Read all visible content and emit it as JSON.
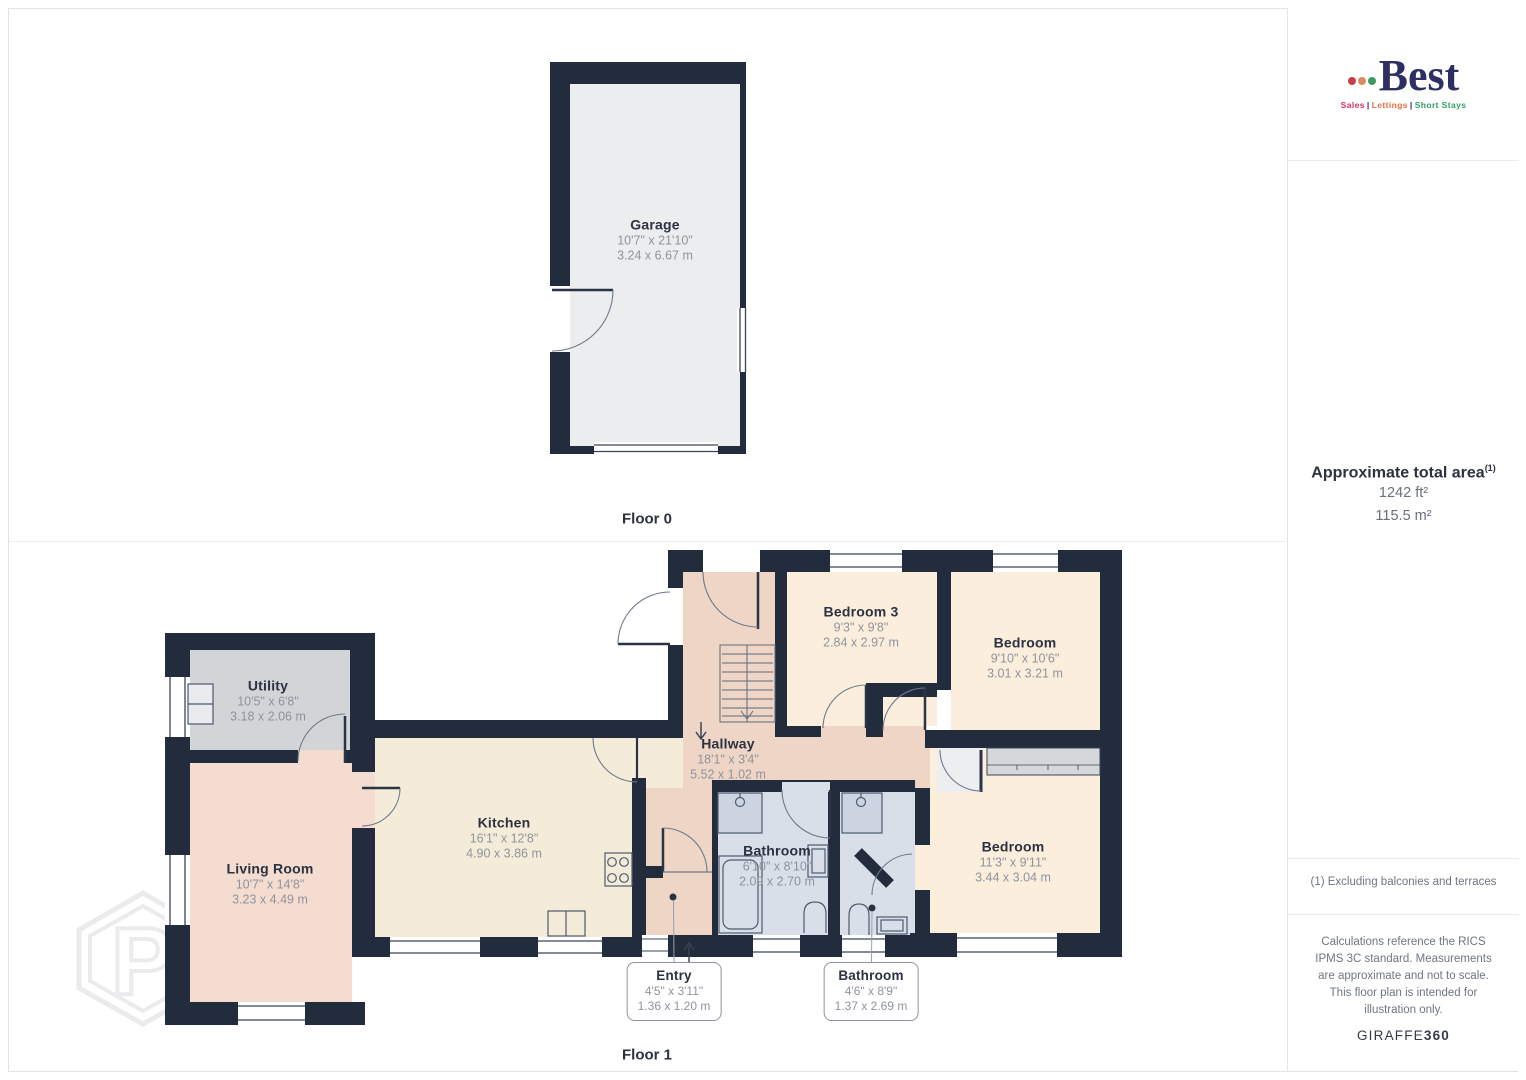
{
  "page": {
    "floor0_label": "Floor 0",
    "floor1_label": "Floor 1"
  },
  "branding": {
    "name": "Best",
    "separator": "|",
    "tagline": [
      "Sales",
      "Lettings",
      "Short Stays"
    ]
  },
  "sidebar": {
    "area_title": "Approximate total area",
    "area_sup": "(1)",
    "area_ft": "1242 ft²",
    "area_m": "115.5 m²",
    "footnote": "(1) Excluding balconies and terraces",
    "disclaimer": "Calculations reference the RICS IPMS 3C standard. Measurements are approximate and not to scale. This floor plan is intended for illustration only.",
    "brand_regular": "GIRAFFE",
    "brand_bold": "360"
  },
  "watermark": {
    "letter": "P"
  },
  "rooms": {
    "garage": {
      "name": "Garage",
      "imperial": "10'7\" x 21'10\"",
      "metric": "3.24 x 6.67 m"
    },
    "utility": {
      "name": "Utility",
      "imperial": "10'5\" x 6'8\"",
      "metric": "3.18 x 2.06 m"
    },
    "living": {
      "name": "Living Room",
      "imperial": "10'7\" x 14'8\"",
      "metric": "3.23 x 4.49 m"
    },
    "kitchen": {
      "name": "Kitchen",
      "imperial": "16'1\" x 12'8\"",
      "metric": "4.90 x 3.86 m"
    },
    "hallway": {
      "name": "Hallway",
      "imperial": "18'1\" x 3'4\"",
      "metric": "5.52 x 1.02 m"
    },
    "bedroom3": {
      "name": "Bedroom 3",
      "imperial": "9'3\" x 9'8\"",
      "metric": "2.84 x 2.97 m"
    },
    "bedroom_tr": {
      "name": "Bedroom",
      "imperial": "9'10\" x 10'6\"",
      "metric": "3.01 x 3.21 m"
    },
    "bedroom_br": {
      "name": "Bedroom",
      "imperial": "11'3\" x 9'11\"",
      "metric": "3.44 x 3.04 m"
    },
    "bathroom": {
      "name": "Bathroom",
      "imperial": "6'10\" x 8'10\"",
      "metric": "2.09 x 2.70 m"
    },
    "entry": {
      "name": "Entry",
      "imperial": "4'5\" x 3'11\"",
      "metric": "1.36 x 1.20 m"
    },
    "bathroom2": {
      "name": "Bathroom",
      "imperial": "4'6\" x 8'9\"",
      "metric": "1.37 x 2.69 m"
    }
  },
  "colors": {
    "wall": "#222c3c",
    "garage_floor": "#ebedef",
    "utility_floor": "#d2d4d8",
    "living_floor": "#f4dcd1",
    "kitchen_floor": "#f4ecd8",
    "hallway_floor": "#efd5c6",
    "bedroom_floor": "#fbeedd",
    "bathroom_floor": "#d9dfe9",
    "wardrobe": "#d5d7da",
    "label_navy": "#2b3240",
    "dim_gray": "#8f949c",
    "logo_navy": "#2d2f63",
    "logo_red": "#c24046",
    "logo_orange": "#dc8a63",
    "logo_green": "#3b9a5c"
  }
}
